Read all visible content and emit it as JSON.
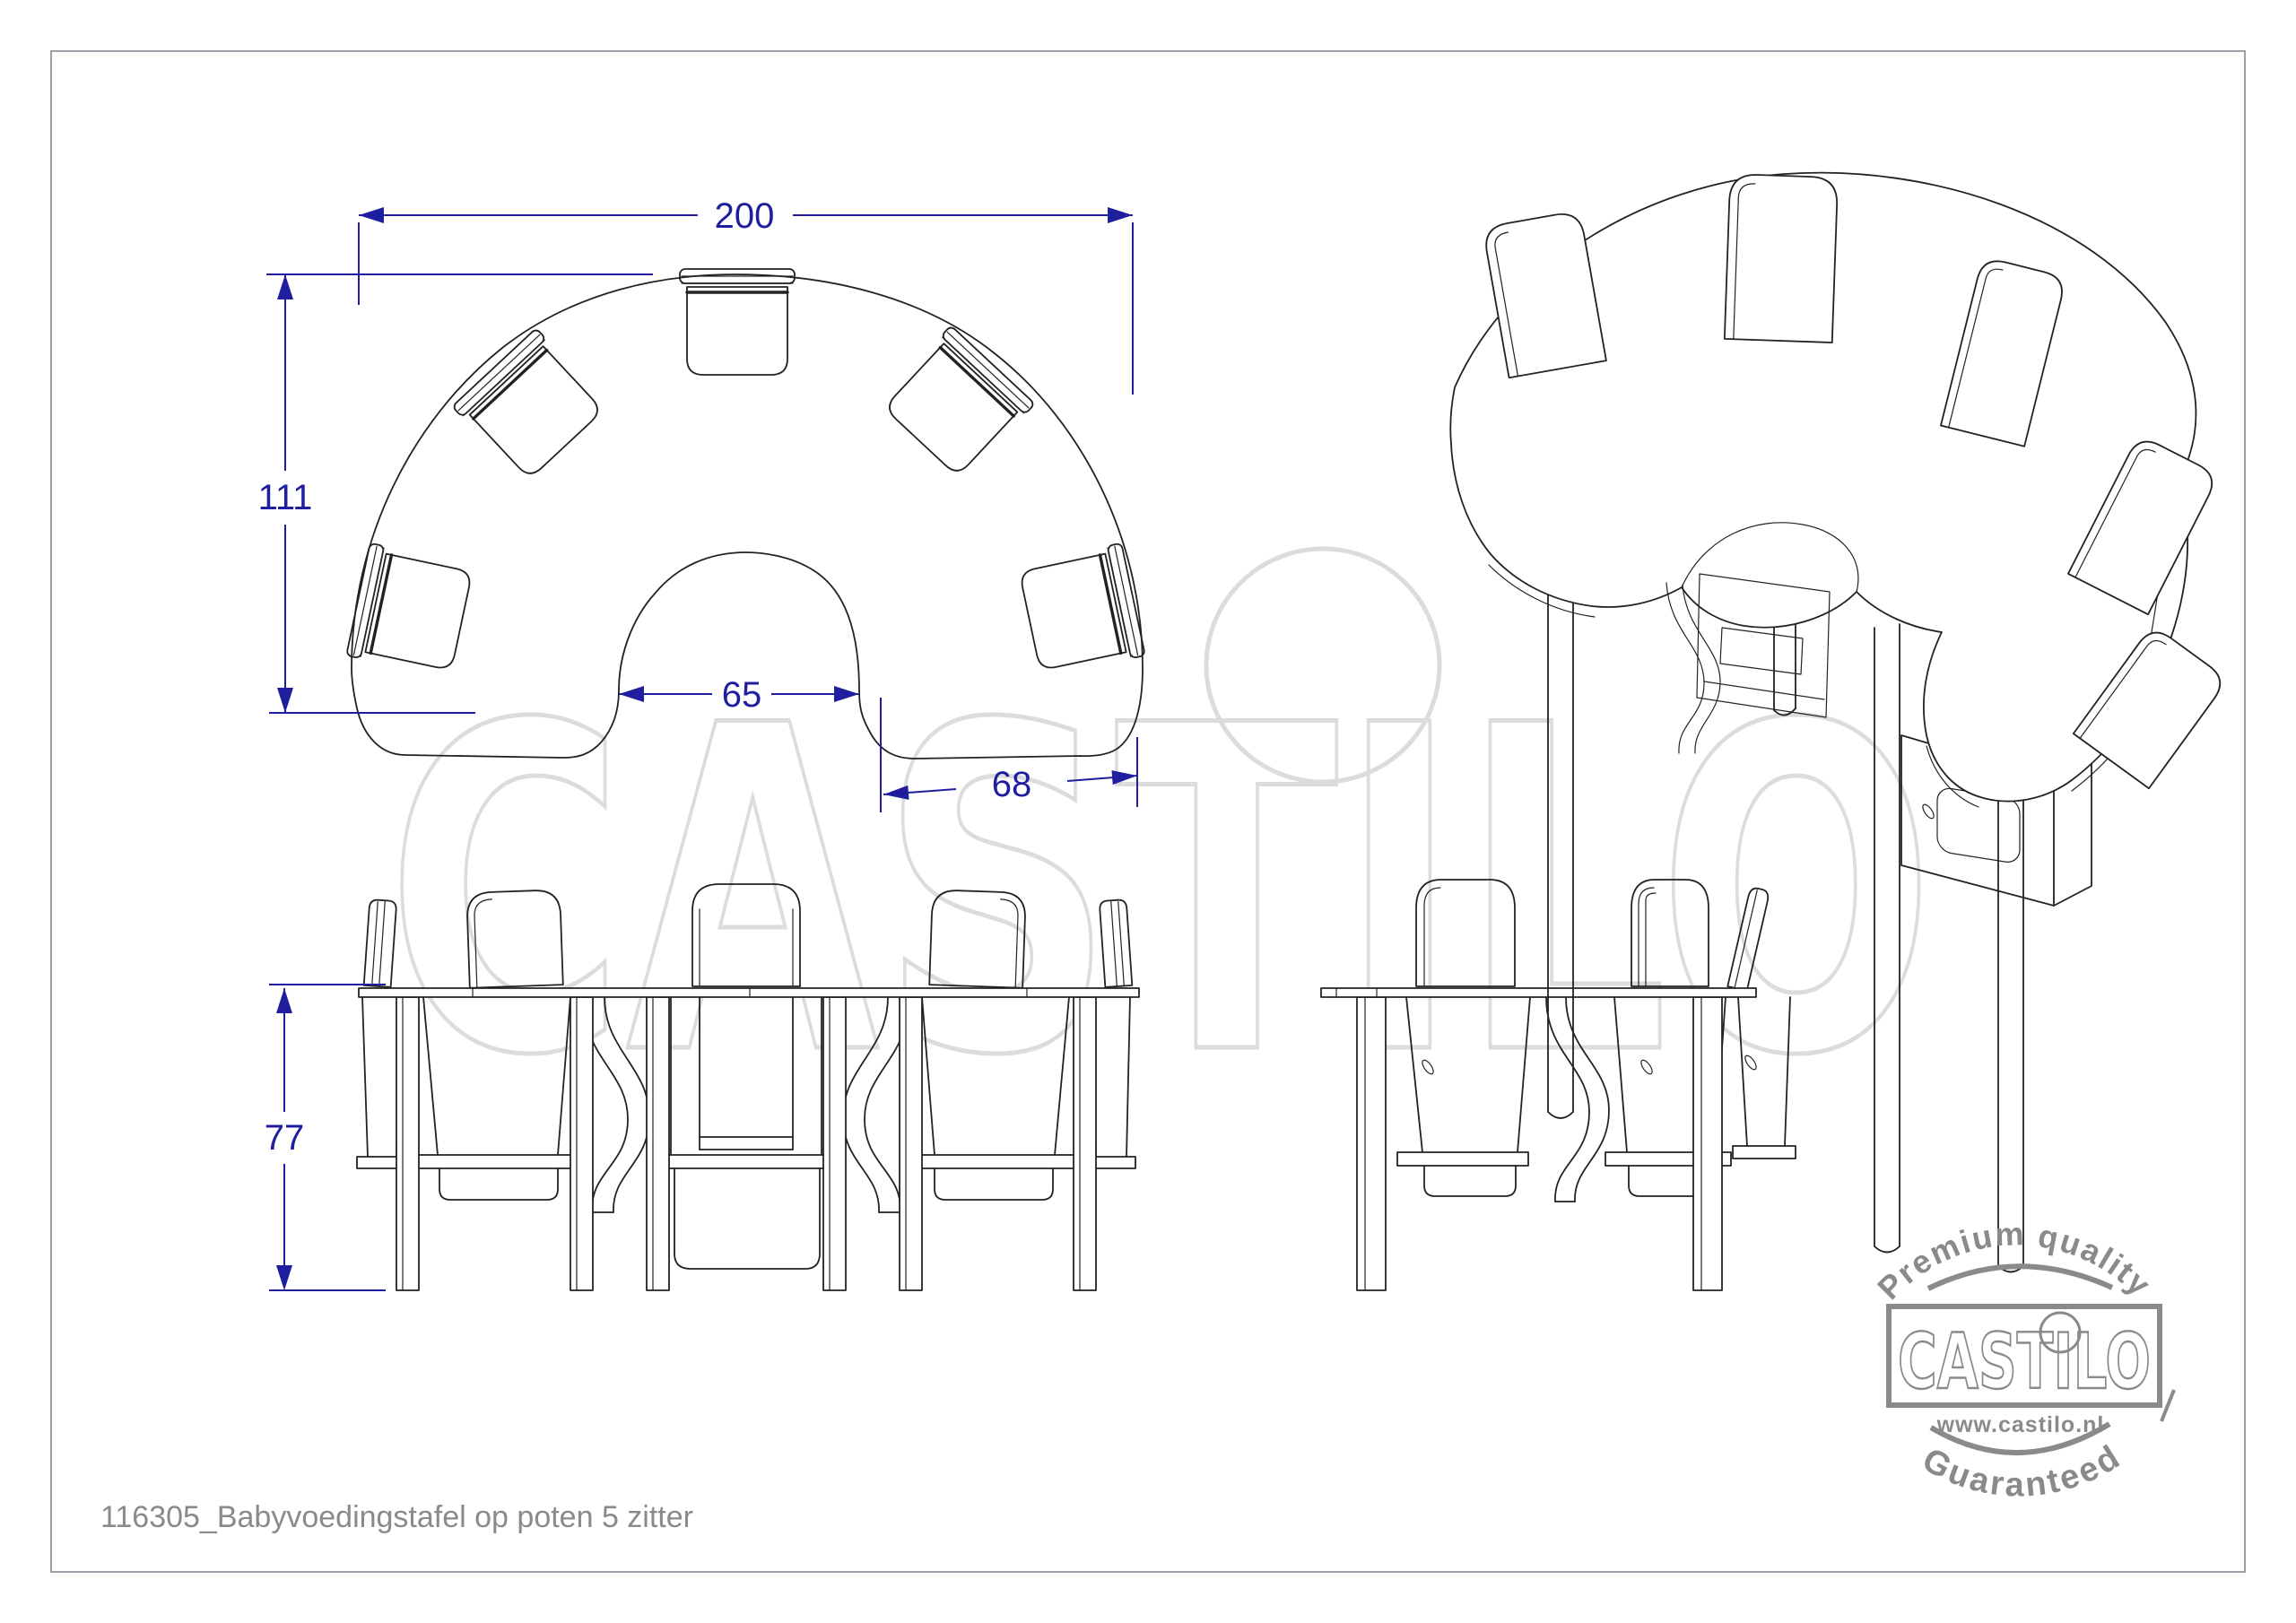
{
  "drawing": {
    "product_title": "116305_Babyvoedingstafel op poten 5 zitter",
    "dimensions": {
      "overall_width": "200",
      "overall_depth": "111",
      "inner_opening": "65",
      "seat_ring_depth": "68",
      "table_height": "77"
    },
    "watermark_text": "CASTILO",
    "stamp": {
      "arc_top": "Premium quality",
      "logo": "CASTILO",
      "url": "www.castilo.nl",
      "arc_bottom": "Guaranteed"
    },
    "colors": {
      "dimension_blue": "#1e1e9e",
      "drawing_line": "#222222",
      "watermark_gray": "#dcdcdc",
      "stamp_gray": "#8a8a8a",
      "title_gray": "#8a8a8a",
      "border_gray": "#9aa0a8"
    }
  }
}
